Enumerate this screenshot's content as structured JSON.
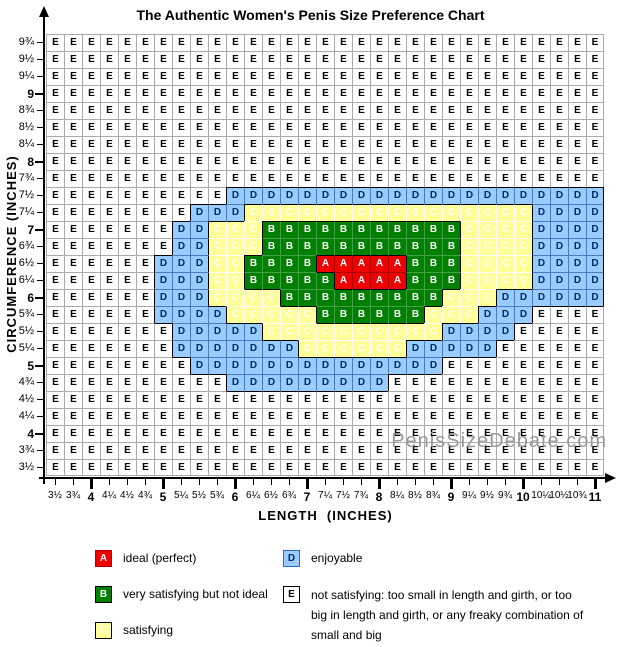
{
  "title": "The Authentic Women's Penis Size Preference Chart",
  "watermark": "PenisSizeDebate.com",
  "chart_data": {
    "type": "heatmap",
    "title": "The Authentic Women's Penis Size Preference Chart",
    "xlabel": "LENGTH  (INCHES)",
    "ylabel": "CIRCUMFERENCE (INCHES)",
    "x_range_inches": [
      3.5,
      11
    ],
    "y_range_inches": [
      3.5,
      9.75
    ],
    "x_labels": [
      "3½",
      "3¾",
      "4",
      "4¼",
      "4½",
      "4¾",
      "5",
      "5¼",
      "5½",
      "5¾",
      "6",
      "6¼",
      "6½",
      "6¾",
      "7",
      "7¼",
      "7½",
      "7¾",
      "8",
      "8¼",
      "8½",
      "8¾",
      "9",
      "9¼",
      "9½",
      "9¾",
      "10",
      "10¼",
      "10½",
      "10¾",
      "11"
    ],
    "y_labels": [
      "9¾",
      "9½",
      "9¼",
      "9",
      "8¾",
      "8½",
      "8¼",
      "8",
      "7¾",
      "7½",
      "7¼",
      "7",
      "6¾",
      "6½",
      "6¼",
      "6",
      "5¾",
      "5½",
      "5¼",
      "5",
      "4¾",
      "4½",
      "4¼",
      "4",
      "3¾",
      "3½"
    ],
    "grid_rows": [
      "EEEEEEEEEEEEEEEEEEEEEEEEEEEEEEE",
      "EEEEEEEEEEEEEEEEEEEEEEEEEEEEEEE",
      "EEEEEEEEEEEEEEEEEEEEEEEEEEEEEEE",
      "EEEEEEEEEEEEEEEEEEEEEEEEEEEEEEE",
      "EEEEEEEEEEEEEEEEEEEEEEEEEEEEEEE",
      "EEEEEEEEEEEEEEEEEEEEEEEEEEEEEEE",
      "EEEEEEEEEEEEEEEEEEEEEEEEEEEEEEE",
      "EEEEEEEEEEEEEEEEEEEEEEEEEEEEEEE",
      "EEEEEEEEEEEEEEEEEEEEEEEEEEEEEEE",
      "EEEEEEEEEEDDDDDDDDDDDDDDDDDDDDD",
      "EEEEEEEEDDDCCCCCCCCCCCCCCCCDDDD",
      "EEEEEEEDDCCCBBBBBBBBBBBCCCCDDDD",
      "EEEEEEEDDCCCBBBBBBBBBBBCCCCDDDD",
      "EEEEEEDDDCCBBBBAAAAABBBCCCCDDDD",
      "EEEEEEDDDCCBBBBBAAAABBBCCCCDDDD",
      "EEEEEEDDDCCCCBBBBBBBBBCCCDDDDDD",
      "EEEEEEDDDDCCCCCBBBBBBCCCDDDEEEE",
      "EEEEEEEDDDDDCCCCCCCCCCDDDDEEEEE",
      "EEEEEEEDDDDDDDCCCCCCDDDDDEEEEEE",
      "EEEEEEEEDDDDDDDDDDDDDDEEEEEEEEE",
      "EEEEEEEEEEDDDDDDDDDEEEEEEEEEEEE",
      "EEEEEEEEEEEEEEEEEEEEEEEEEEEEEEE",
      "EEEEEEEEEEEEEEEEEEEEEEEEEEEEEEE",
      "EEEEEEEEEEEEEEEEEEEEEEEEEEEEEEE",
      "EEEEEEEEEEEEEEEEEEEEEEEEEEEEEEE",
      "EEEEEEEEEEEEEEEEEEEEEEEEEEEEEEE"
    ],
    "cells": {
      "A": {
        "color": "#ee0000",
        "text_color": "#ffffff",
        "inner_border": "#aa0000",
        "box_border": "#bb0000"
      },
      "B": {
        "color": "#008000",
        "text_color": "#ffffff",
        "inner_border": "#44a044",
        "box_border": "#000000"
      },
      "C": {
        "color": "#ffff99",
        "text_color": "#ffffff",
        "inner_border": "#ffffff",
        "box_border": "#000000"
      },
      "D": {
        "color": "#99ccff",
        "text_color": "#002b66",
        "inner_border": "#4d79c2",
        "box_border": "#3366cc"
      },
      "E": {
        "color": "#ffffff",
        "text_color": "#000000",
        "inner_border": "#aaaaaa",
        "box_border": "#000000"
      }
    },
    "legend": [
      {
        "letter": "A",
        "label": "ideal (perfect)"
      },
      {
        "letter": "B",
        "label": "very satisfying but not ideal"
      },
      {
        "letter": "C",
        "label": "satisfying"
      },
      {
        "letter": "D",
        "label": "enjoyable"
      },
      {
        "letter": "E",
        "label": "not satisfying: too small in length and girth, or too big in length and girth, or any freaky combination of small and big"
      }
    ]
  }
}
